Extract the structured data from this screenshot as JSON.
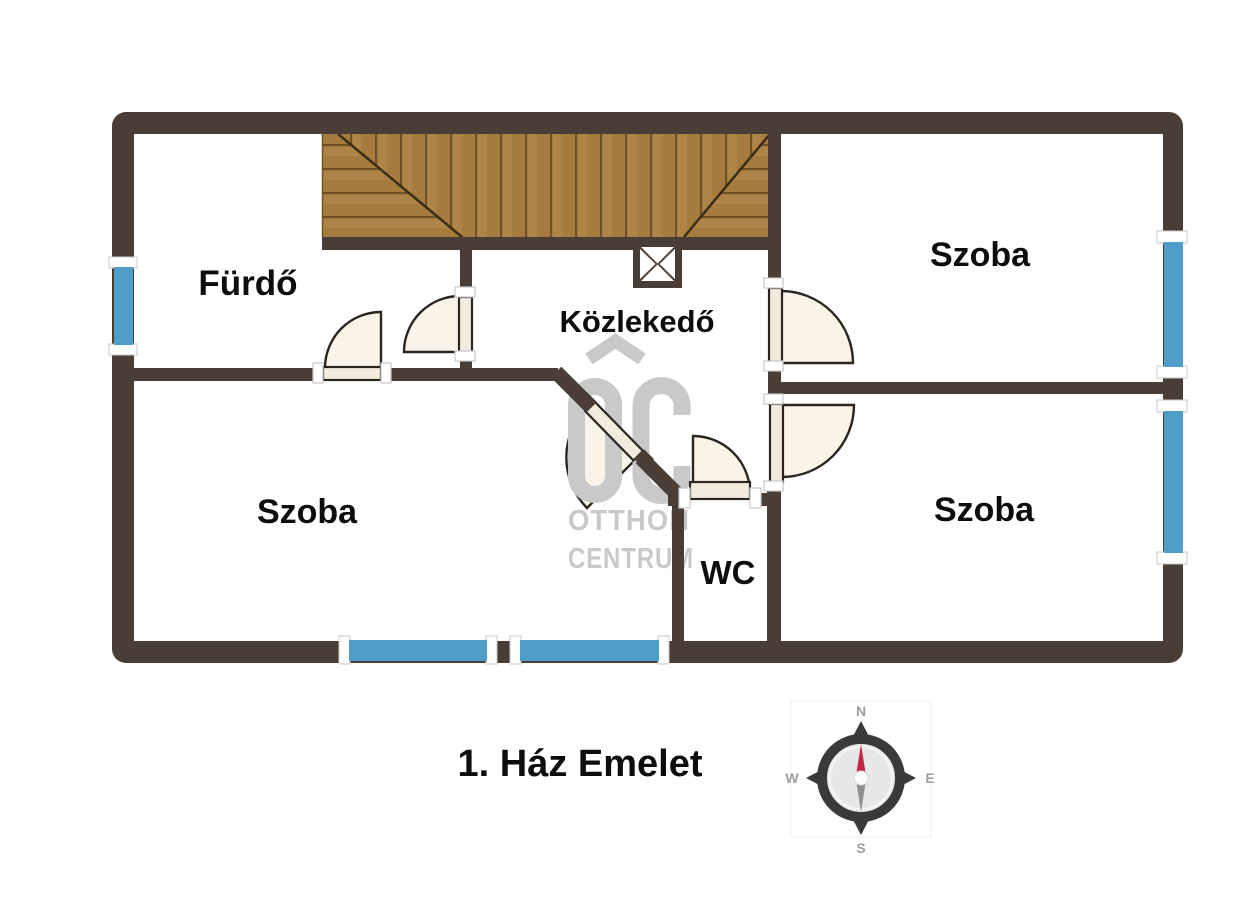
{
  "floor_plan": {
    "title": "1. Ház Emelet",
    "rooms": {
      "bathroom": "Fürdő",
      "hallway": "Közlekedő",
      "room_top_right": "Szoba",
      "room_bottom_left": "Szoba",
      "room_bottom_right": "Szoba",
      "wc": "WC"
    },
    "watermark": {
      "logo": "OC",
      "line1": "OTTHON",
      "line2": "CENTRUM"
    },
    "compass": {
      "north": "N",
      "east": "E",
      "south": "S",
      "west": "W"
    },
    "colors": {
      "wall": "#4A3D35",
      "window": "#4E9EC9",
      "wood": "#A67C3E",
      "door_leaf": "#F2EADB",
      "door_arc_fill": "#FAF4E8",
      "watermark": "#C9C9C9",
      "compass_needle_north": "#C32745",
      "compass_needle_south": "#8F8F8F"
    }
  }
}
